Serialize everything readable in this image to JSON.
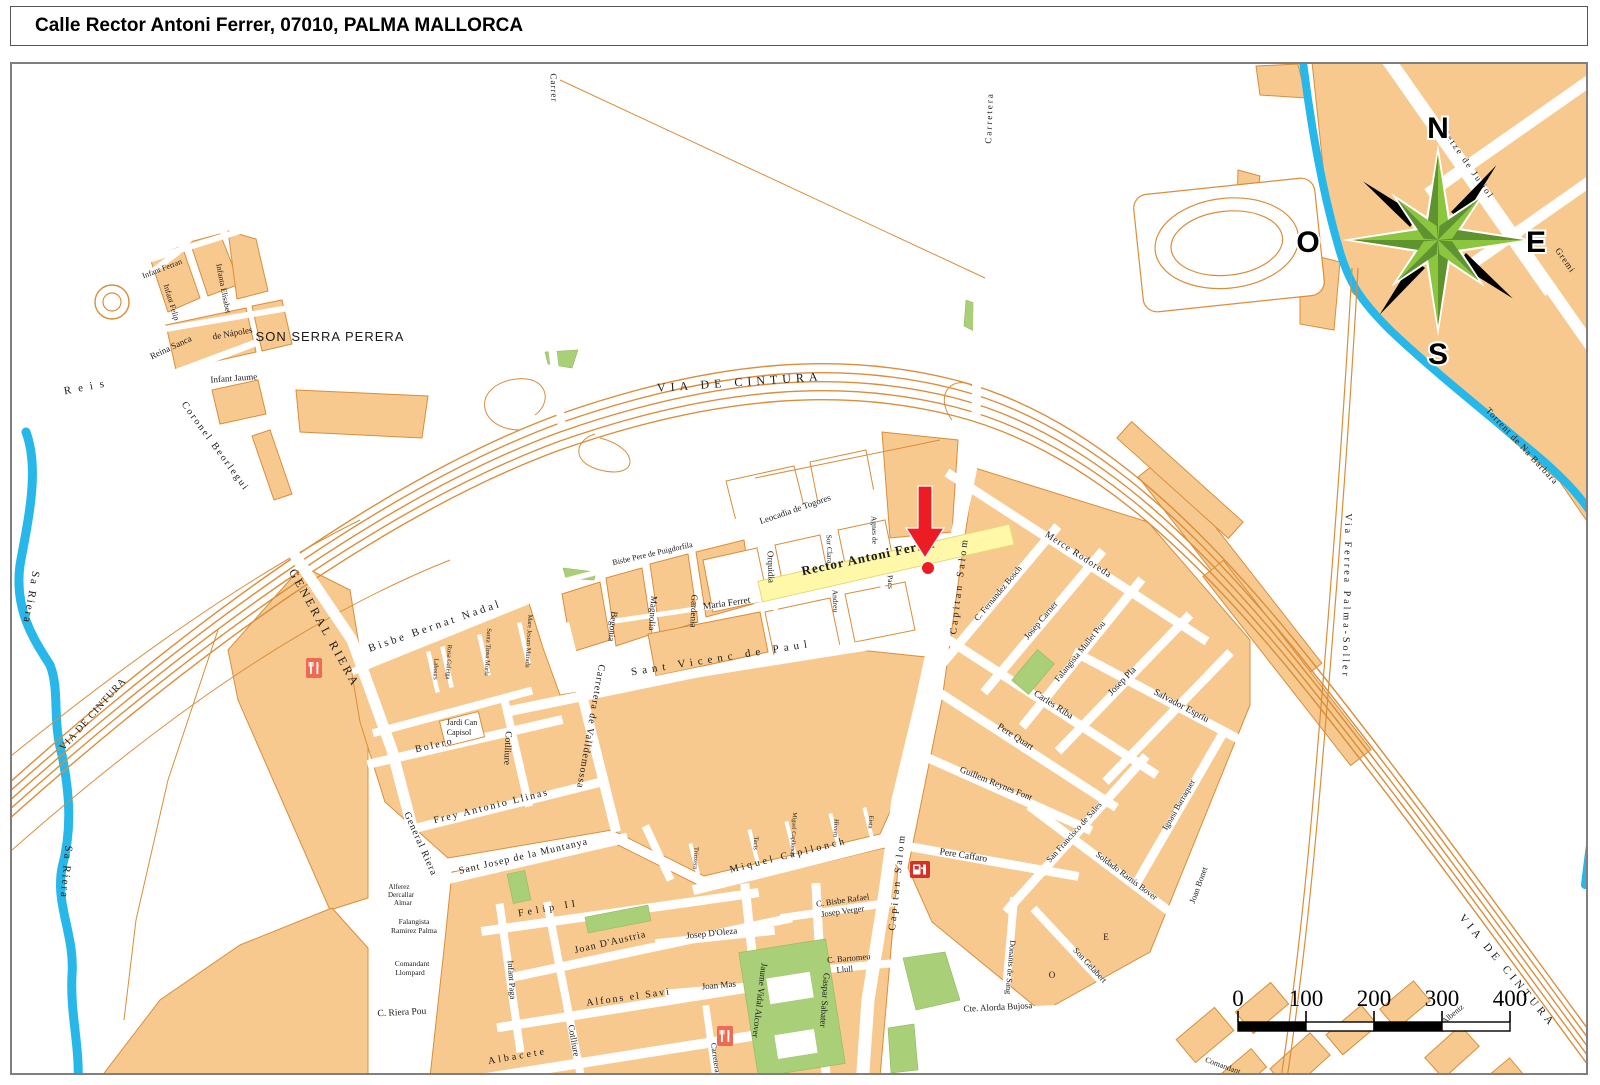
{
  "title": "Calle Rector Antoni Ferrer, 07010, PALMA MALLORCA",
  "colors": {
    "block": "#F8C98E",
    "block_outline": "#D98E3B",
    "water": "#27B7E8",
    "green": "#A9CF79",
    "highlight_street": "#FFF8A8",
    "marker_red": "#EC1C24",
    "compass_green_light": "#8CC63F",
    "compass_green_dark": "#5F9330"
  },
  "compass": {
    "points": [
      {
        "t": "N",
        "x": 1438,
        "y": 138
      },
      {
        "t": "E",
        "x": 1536,
        "y": 252
      },
      {
        "t": "S",
        "x": 1438,
        "y": 364
      },
      {
        "t": "O",
        "x": 1308,
        "y": 252
      }
    ]
  },
  "scale_bar": {
    "x": 1238,
    "y": 1022,
    "segment_px": 68,
    "height": 9,
    "ticks": [
      "0",
      "100",
      "200",
      "300",
      "400"
    ]
  },
  "marker": {
    "street": "Rector Antoni Ferrer",
    "arrow_x": 925,
    "arrow_y": 520,
    "dot_x": 928,
    "dot_y": 568
  },
  "map": {
    "district_label": "SON SERRA PERERA",
    "icons": [
      {
        "name": "restaurant-icon",
        "x": 306,
        "y": 658
      },
      {
        "name": "restaurant-icon",
        "x": 717,
        "y": 1026
      },
      {
        "name": "gas-station-icon",
        "x": 910,
        "y": 861
      }
    ],
    "labels": [
      {
        "t": "VIA DE CINTURA",
        "x": 740,
        "y": 386,
        "r": -4,
        "s": 12,
        "sp": 5
      },
      {
        "t": "VIA DE CINTURA",
        "x": 95,
        "y": 716,
        "r": -48,
        "s": 10,
        "sp": 1
      },
      {
        "t": "VIA DE CINTURA",
        "x": 1505,
        "y": 973,
        "r": 50,
        "s": 11,
        "sp": 4
      },
      {
        "t": "Sa Riera",
        "x": 28,
        "y": 597,
        "r": 100,
        "s": 11,
        "sp": 2
      },
      {
        "t": "Sa Riera",
        "x": 63,
        "y": 872,
        "r": 95,
        "s": 11,
        "sp": 2
      },
      {
        "t": "Torrent de Na Barbara",
        "x": 1520,
        "y": 448,
        "r": 47,
        "s": 9,
        "sp": 1
      },
      {
        "t": "Via Ferrea Palma-Soller",
        "x": 1344,
        "y": 596,
        "r": 91,
        "s": 10,
        "sp": 3
      },
      {
        "t": "Setze de Juliol",
        "x": 1466,
        "y": 166,
        "r": 55,
        "s": 9,
        "sp": 2
      },
      {
        "t": "Gremi",
        "x": 1563,
        "y": 262,
        "r": 55,
        "s": 9,
        "sp": 1
      },
      {
        "t": "SON SERRA PERERA",
        "x": 330,
        "y": 341,
        "r": 0,
        "s": 13,
        "sp": 1,
        "f": "sans"
      },
      {
        "t": "Reis",
        "x": 88,
        "y": 390,
        "r": -11,
        "s": 11,
        "sp": 7
      },
      {
        "t": "Coronel Beorlegui",
        "x": 213,
        "y": 448,
        "r": 54,
        "s": 10,
        "sp": 2
      },
      {
        "t": "Infant Ferran",
        "x": 163,
        "y": 271,
        "r": -21,
        "s": 8
      },
      {
        "t": "Infant Felip",
        "x": 169,
        "y": 303,
        "r": 73,
        "s": 8
      },
      {
        "t": "Infanta Elisabet",
        "x": 221,
        "y": 289,
        "r": 79,
        "s": 8
      },
      {
        "t": "Reina Sanca",
        "x": 172,
        "y": 350,
        "r": -25,
        "s": 9
      },
      {
        "t": "de Nápoles",
        "x": 233,
        "y": 336,
        "r": -10,
        "s": 9
      },
      {
        "t": "Infant Jaume",
        "x": 234,
        "y": 381,
        "r": -4,
        "s": 9
      },
      {
        "t": "GENERAL RIERA",
        "x": 321,
        "y": 630,
        "r": 61,
        "s": 12,
        "sp": 3
      },
      {
        "t": "General Riera",
        "x": 418,
        "y": 845,
        "r": 66,
        "s": 10,
        "sp": 1
      },
      {
        "t": "Bisbe Pere de Puigdorfila",
        "x": 653,
        "y": 556,
        "r": -13,
        "s": 8
      },
      {
        "t": "Leocadia de Togores",
        "x": 796,
        "y": 512,
        "r": -19,
        "s": 9
      },
      {
        "t": "Orquidia",
        "x": 768,
        "y": 567,
        "r": 88,
        "s": 9
      },
      {
        "t": "Sor Clara",
        "x": 827,
        "y": 549,
        "r": 88,
        "s": 7.5
      },
      {
        "t": "Andreu",
        "x": 833,
        "y": 601,
        "r": 88,
        "s": 7.5
      },
      {
        "t": "Agnes de",
        "x": 872,
        "y": 530,
        "r": 88,
        "s": 7.5
      },
      {
        "t": "Pacs",
        "x": 888,
        "y": 582,
        "r": 88,
        "s": 7.5
      },
      {
        "t": "Rector Antoni Ferrer",
        "x": 870,
        "y": 561,
        "r": -12,
        "s": 13,
        "sp": 1,
        "w": 600
      },
      {
        "t": "Maria Ferret",
        "x": 727,
        "y": 606,
        "r": -8,
        "s": 9.5
      },
      {
        "t": "Sant Vicenc de Paul",
        "x": 722,
        "y": 661,
        "r": -9,
        "s": 11,
        "sp": 5
      },
      {
        "t": "Carretera de Valldemossa",
        "x": 588,
        "y": 726,
        "r": 100,
        "s": 10,
        "sp": 1
      },
      {
        "t": "Begonia",
        "x": 610,
        "y": 626,
        "r": 96,
        "s": 9
      },
      {
        "t": "Magnolia",
        "x": 650,
        "y": 613,
        "r": 94,
        "s": 9
      },
      {
        "t": "Gardenia",
        "x": 691,
        "y": 611,
        "r": 92,
        "s": 9
      },
      {
        "t": "Cotlliure",
        "x": 505,
        "y": 748,
        "r": 93,
        "s": 9.5
      },
      {
        "t": "Bisbe Bernat Nadal",
        "x": 436,
        "y": 629,
        "r": -19,
        "s": 11,
        "sp": 3
      },
      {
        "t": "Labours",
        "x": 434,
        "y": 669,
        "r": 93,
        "s": 6.5
      },
      {
        "t": "Rosa Galetga",
        "x": 447,
        "y": 662,
        "r": 93,
        "s": 6.5
      },
      {
        "t": "Santa Tinsa Morla",
        "x": 486,
        "y": 652,
        "r": 93,
        "s": 6.5
      },
      {
        "t": "Mare Jesum Murada",
        "x": 527,
        "y": 641,
        "r": 93,
        "s": 6.5
      },
      {
        "t": "Jardi Can",
        "x": 462,
        "y": 725,
        "s": 8
      },
      {
        "t": "Capisol",
        "x": 459,
        "y": 735,
        "s": 8
      },
      {
        "t": "Bolero",
        "x": 435,
        "y": 748,
        "r": -13,
        "s": 10,
        "sp": 2
      },
      {
        "t": "Frey Antonio Llinas",
        "x": 492,
        "y": 809,
        "r": -14,
        "s": 10,
        "sp": 2
      },
      {
        "t": "Sant Josep de la Muntanya",
        "x": 524,
        "y": 859,
        "r": -13,
        "s": 10,
        "sp": 1
      },
      {
        "t": "Felip II",
        "x": 549,
        "y": 911,
        "r": -10,
        "s": 10,
        "sp": 4
      },
      {
        "t": "Joan D'Austria",
        "x": 611,
        "y": 945,
        "r": -13,
        "s": 10,
        "sp": 1
      },
      {
        "t": "Alfons el Savi",
        "x": 629,
        "y": 1000,
        "r": -8,
        "s": 10,
        "sp": 2
      },
      {
        "t": "Albacete",
        "x": 518,
        "y": 1059,
        "r": -10,
        "s": 10,
        "sp": 3
      },
      {
        "t": "C. Riera Pou",
        "x": 402,
        "y": 1015,
        "r": -3,
        "s": 9.5
      },
      {
        "t": "Comandant",
        "x": 412,
        "y": 966,
        "s": 7.5
      },
      {
        "t": "Llompard",
        "x": 410,
        "y": 975,
        "s": 7.5
      },
      {
        "t": "Falangista",
        "x": 414,
        "y": 924,
        "s": 7.5
      },
      {
        "t": "Ramirez Palma",
        "x": 414,
        "y": 933,
        "s": 7.5
      },
      {
        "t": "Alferez",
        "x": 399,
        "y": 889,
        "s": 7
      },
      {
        "t": "Dercallar",
        "x": 401,
        "y": 897,
        "s": 7
      },
      {
        "t": "Almar",
        "x": 403,
        "y": 905,
        "s": 7
      },
      {
        "t": "Infant Paga",
        "x": 509,
        "y": 980,
        "r": 86,
        "s": 8.5
      },
      {
        "t": "Cotlliure",
        "x": 571,
        "y": 1041,
        "r": 80,
        "s": 9
      },
      {
        "t": "Josep D'Oleza",
        "x": 712,
        "y": 936,
        "r": -6,
        "s": 9
      },
      {
        "t": "Joan Mas",
        "x": 719,
        "y": 988,
        "r": -5,
        "s": 9
      },
      {
        "t": "Jaume Vidal Alcover",
        "x": 757,
        "y": 1000,
        "r": 97,
        "s": 9
      },
      {
        "t": "Gaspar Sabater",
        "x": 822,
        "y": 1000,
        "r": 94,
        "s": 9
      },
      {
        "t": "Miquel Capllonch",
        "x": 789,
        "y": 858,
        "r": -14,
        "s": 10,
        "sp": 3
      },
      {
        "t": "Trinxera",
        "x": 694,
        "y": 858,
        "r": 93,
        "s": 6.5
      },
      {
        "t": "Tacis",
        "x": 754,
        "y": 843,
        "r": 93,
        "s": 6.5
      },
      {
        "t": "Miguel Capllonch",
        "x": 792,
        "y": 834,
        "r": 93,
        "s": 6
      },
      {
        "t": "Hivern",
        "x": 834,
        "y": 828,
        "r": 93,
        "s": 6.5
      },
      {
        "t": "Eista",
        "x": 869,
        "y": 822,
        "r": 93,
        "s": 6.5
      },
      {
        "t": "C. Bisbe Rafael",
        "x": 843,
        "y": 903,
        "r": -8,
        "s": 8.5
      },
      {
        "t": "Josep Verger",
        "x": 843,
        "y": 914,
        "r": -8,
        "s": 8.5
      },
      {
        "t": "C. Bartomeu",
        "x": 849,
        "y": 961,
        "r": -5,
        "s": 8.5
      },
      {
        "t": "Llull",
        "x": 845,
        "y": 972,
        "r": -5,
        "s": 8.5
      },
      {
        "t": "Capitan Salom",
        "x": 962,
        "y": 586,
        "r": -83,
        "s": 10,
        "sp": 3
      },
      {
        "t": "Capitan Salom",
        "x": 900,
        "y": 882,
        "r": -84,
        "s": 10,
        "sp": 3
      },
      {
        "t": "Carretera",
        "x": 992,
        "y": 118,
        "r": -88,
        "s": 9,
        "sp": 2
      },
      {
        "t": "Carrer",
        "x": 551,
        "y": 88,
        "r": 88,
        "s": 9,
        "sp": 1
      },
      {
        "t": "C. Fernandez Bosch",
        "x": 1000,
        "y": 595,
        "r": -50,
        "s": 8.5
      },
      {
        "t": "Merce Rodoreda",
        "x": 1077,
        "y": 557,
        "r": 33,
        "s": 9.5,
        "sp": 1
      },
      {
        "t": "Josep Carner",
        "x": 1043,
        "y": 622,
        "r": -50,
        "s": 9
      },
      {
        "t": "Falangista Mullet Pou",
        "x": 1082,
        "y": 653,
        "r": -51,
        "s": 8.5
      },
      {
        "t": "Josep Pla",
        "x": 1124,
        "y": 683,
        "r": -46,
        "s": 9.5
      },
      {
        "t": "Salvador Espriu",
        "x": 1180,
        "y": 708,
        "r": 28,
        "s": 9.5
      },
      {
        "t": "Carles Riba",
        "x": 1052,
        "y": 707,
        "r": 33,
        "s": 9.5
      },
      {
        "t": "Pere Quart",
        "x": 1014,
        "y": 739,
        "r": 33,
        "s": 9.5
      },
      {
        "t": "Guillem Reynes Font",
        "x": 995,
        "y": 786,
        "r": 22,
        "s": 9
      },
      {
        "t": "Pere Caffaro",
        "x": 963,
        "y": 858,
        "r": 9,
        "s": 9.5
      },
      {
        "t": "San Francisco de Sales",
        "x": 1076,
        "y": 834,
        "r": -48,
        "s": 8.5
      },
      {
        "t": "Soldado Ramis Bover",
        "x": 1125,
        "y": 878,
        "r": 37,
        "s": 8.5
      },
      {
        "t": "Ignasi Barraquer",
        "x": 1181,
        "y": 806,
        "r": -60,
        "s": 8.5
      },
      {
        "t": "Joan Bonet",
        "x": 1201,
        "y": 886,
        "r": -70,
        "s": 8.5
      },
      {
        "t": "Donants de Sang",
        "x": 1008,
        "y": 967,
        "r": 95,
        "s": 8
      },
      {
        "t": "Son Gelabert",
        "x": 1088,
        "y": 967,
        "r": 47,
        "s": 8.5
      },
      {
        "t": "O",
        "x": 1052,
        "y": 978,
        "s": 9
      },
      {
        "t": "E",
        "x": 1106,
        "y": 940,
        "s": 9
      },
      {
        "t": "Cte. Alorda Bujosa",
        "x": 998,
        "y": 1010,
        "r": -3,
        "s": 9
      },
      {
        "t": "I. Albeniz",
        "x": 1452,
        "y": 1018,
        "r": -40,
        "s": 8
      },
      {
        "t": "Comandant",
        "x": 1222,
        "y": 1068,
        "r": 20,
        "s": 8
      },
      {
        "t": "Carretera",
        "x": 713,
        "y": 1058,
        "r": 82,
        "s": 8
      }
    ]
  }
}
